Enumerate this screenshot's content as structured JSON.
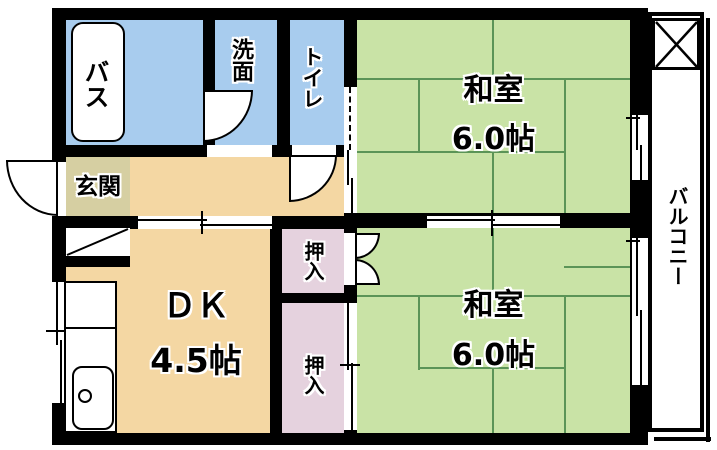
{
  "plan": {
    "bath": {
      "label": "バス"
    },
    "washroom": {
      "label": "洗面"
    },
    "toilet": {
      "label": "トイレ"
    },
    "entrance": {
      "label": "玄関"
    },
    "dk": {
      "label": "ＤＫ",
      "size": "4.5帖"
    },
    "washitsu_top": {
      "label": "和室",
      "size": "6.0帖"
    },
    "washitsu_bottom": {
      "label": "和室",
      "size": "6.0帖"
    },
    "closet_top": {
      "label": "押入"
    },
    "closet_bottom": {
      "label": "押入"
    },
    "balcony": {
      "label": "バルコニー"
    }
  },
  "colors": {
    "wall": "#000000",
    "wet": "#a8ccee",
    "tatami": "#c9e3a6",
    "tatami-line": "#5b9457",
    "wood": "#f4d7a3",
    "entr": "#d6cfa2",
    "closet": "#e5d2de",
    "paper": "#ffffff"
  }
}
